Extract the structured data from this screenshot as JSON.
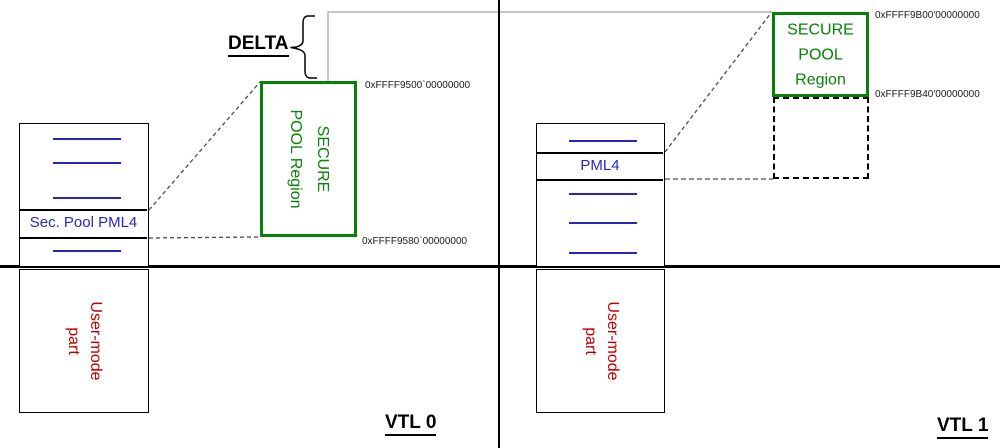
{
  "colors": {
    "secure_pool_green": "#068206",
    "table_blue": "#2626c4",
    "user_mode_red": "#c00000",
    "delta_line_gray": "#b3b3b3",
    "mapping_dash_gray": "#4d4d4d"
  },
  "delta": {
    "label": "DELTA"
  },
  "vtl0": {
    "label": "VTL 0",
    "pml4_table": {
      "entry_label": "Sec. Pool PML4"
    },
    "user_box": {
      "label": "User-mode\npart"
    },
    "secure_pool": {
      "label": "SECURE\nPOOL Region",
      "addr_start": "0xFFFF9500`00000000",
      "addr_end": "0xFFFF9580`00000000"
    }
  },
  "vtl1": {
    "label": "VTL 1",
    "pml4_table": {
      "entry_label": "PML4"
    },
    "user_box": {
      "label": "User-mode\npart"
    },
    "secure_pool": {
      "label": "SECURE\nPOOL\nRegion",
      "addr_start": "0xFFFF9B00'00000000",
      "addr_end": "0xFFFF9B40'00000000"
    }
  }
}
